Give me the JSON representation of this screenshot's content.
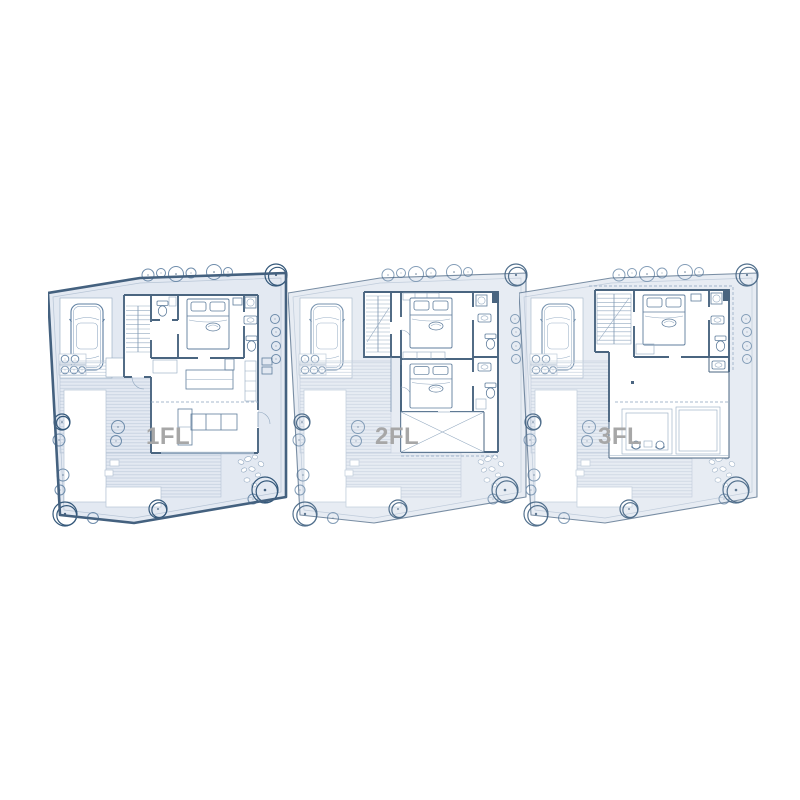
{
  "figure": {
    "type": "architectural-floor-plans",
    "background": "#ffffff",
    "floors": [
      {
        "id": "1fl",
        "label": "1FL"
      },
      {
        "id": "2fl",
        "label": "2FL"
      },
      {
        "id": "3fl",
        "label": "3FL"
      }
    ],
    "colors": {
      "wall": "#4a6580",
      "line": "#7e97b1",
      "site_fill": "#e3e9f2",
      "boundary": "#44617f",
      "tree": "#6e8cab",
      "tree_dark": "#34587a",
      "deck_board": "#c3cfdd",
      "label_gray": "#a7a7a7"
    }
  }
}
